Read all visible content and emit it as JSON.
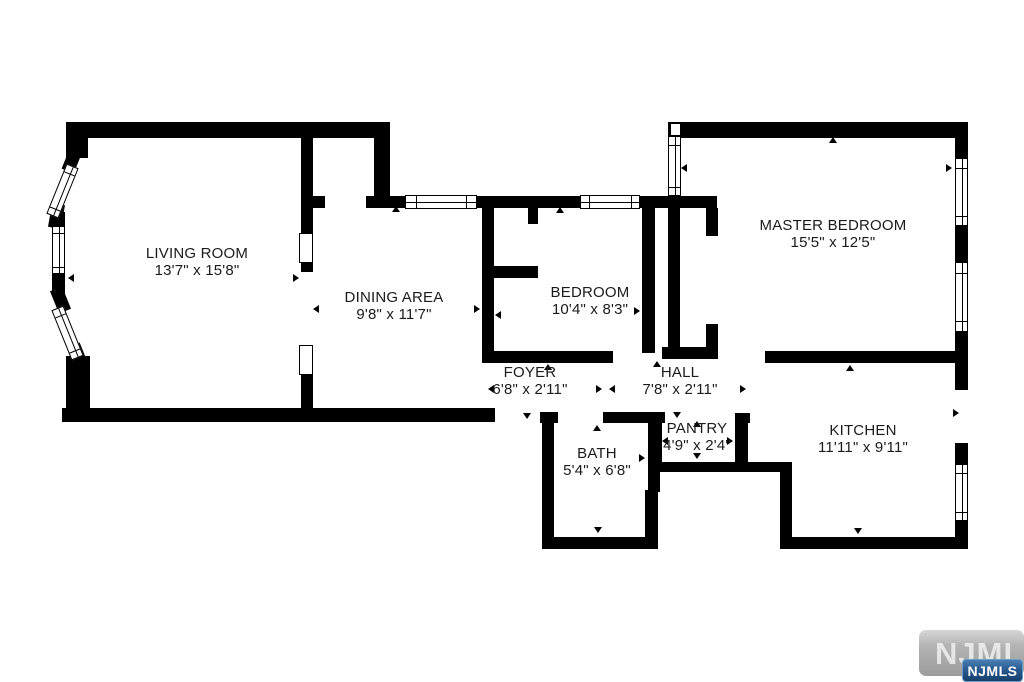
{
  "rooms": [
    {
      "id": "living-room",
      "name": "LIVING ROOM",
      "dimensions": "13'7\" x 15'8\""
    },
    {
      "id": "dining-area",
      "name": "DINING AREA",
      "dimensions": "9'8\" x 11'7\""
    },
    {
      "id": "bedroom",
      "name": "BEDROOM",
      "dimensions": "10'4\" x 8'3\""
    },
    {
      "id": "master-bedroom",
      "name": "MASTER BEDROOM",
      "dimensions": "15'5\" x 12'5\""
    },
    {
      "id": "foyer",
      "name": "FOYER",
      "dimensions": "6'8\" x 2'11\""
    },
    {
      "id": "hall",
      "name": "HALL",
      "dimensions": "7'8\" x 2'11\""
    },
    {
      "id": "bath",
      "name": "BATH",
      "dimensions": "5'4\" x 6'8\""
    },
    {
      "id": "pantry",
      "name": "PANTRY",
      "dimensions": "4'9\" x 2'4\""
    },
    {
      "id": "kitchen",
      "name": "KITCHEN",
      "dimensions": "11'11\" x 9'11\""
    }
  ],
  "watermark": {
    "background_text": "NJMLS",
    "badge_text": "NJMLS"
  },
  "colors": {
    "wall": "#000000",
    "badge_blue": "#1c4a7c",
    "watermark_gray": "#a9a9a9"
  }
}
